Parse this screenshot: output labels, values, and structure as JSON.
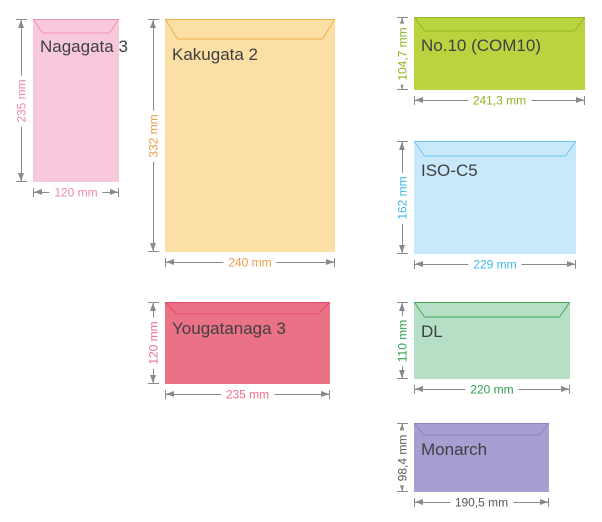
{
  "page": {
    "background": "#ffffff",
    "arrow_color": "#8a8a8a",
    "name_text_color": "#3f3f44"
  },
  "envelopes": [
    {
      "name": "Nagagata 3",
      "height_label": "235 mm",
      "width_label": "120 mm",
      "fill": "#f8c8dc",
      "flap_stroke": "#f090b8",
      "dim_color": "#ee86ae"
    },
    {
      "name": "Kakugata 2",
      "height_label": "332 mm",
      "width_label": "240 mm",
      "fill": "#fbdfa4",
      "flap_stroke": "#eeb14d",
      "dim_color": "#eb9b45"
    },
    {
      "name": "Yougatanaga 3",
      "height_label": "120 mm",
      "width_label": "235 mm",
      "fill": "#ea7186",
      "flap_stroke": "#e24f6e",
      "dim_color": "#ef6d8d"
    },
    {
      "name": "No.10 (COM10)",
      "height_label": "104,7 mm",
      "width_label": "241,3 mm",
      "fill": "#b9d43e",
      "flap_stroke": "#94b42a",
      "dim_color": "#8cb422"
    },
    {
      "name": "ISO-C5",
      "height_label": "162 mm",
      "width_label": "229 mm",
      "fill": "#c9e8fa",
      "flap_stroke": "#6ec6f0",
      "dim_color": "#41b4e9"
    },
    {
      "name": "DL",
      "height_label": "110 mm",
      "width_label": "220 mm",
      "fill": "#b5e0c5",
      "flap_stroke": "#43a556",
      "dim_color": "#2f9e50"
    },
    {
      "name": "Monarch",
      "height_label": "98,4 mm",
      "width_label": "190,5 mm",
      "fill": "#a89ed1",
      "flap_stroke": "#8d81c0",
      "dim_color": "#59595b"
    }
  ]
}
